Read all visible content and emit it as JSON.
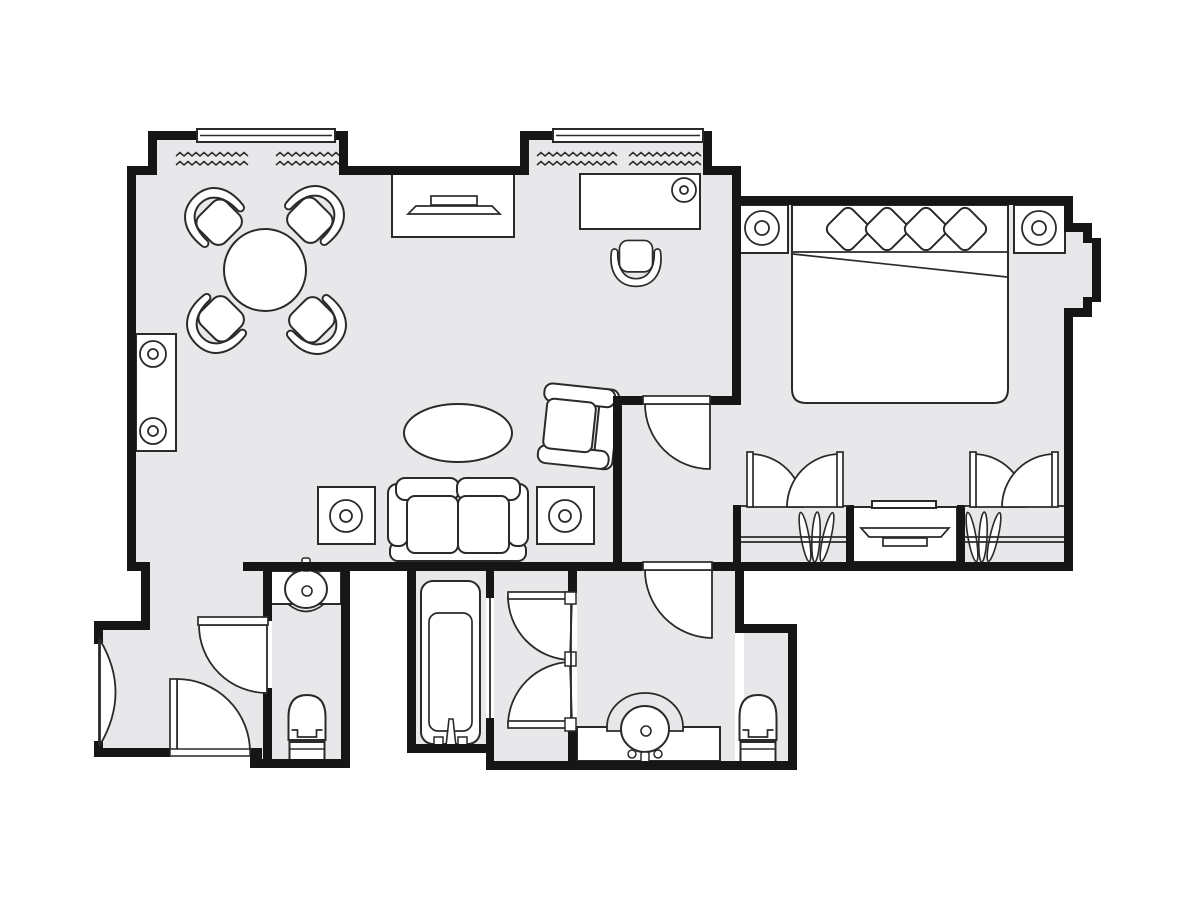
{
  "title": "hotel-suite-floor-plan",
  "canvas": {
    "w": 1200,
    "h": 900
  },
  "colors": {
    "bg": "#ffffff",
    "floor": "#e8e8ea",
    "wall": "#161616",
    "line": "#2a2a2a",
    "fill": "#ffffff"
  },
  "floors": [
    [
      136,
      172,
      601,
      395
    ],
    [
      157,
      140,
      182,
      35
    ],
    [
      529,
      140,
      174,
      35
    ],
    [
      741,
      205,
      323,
      357
    ],
    [
      622,
      405,
      119,
      157
    ],
    [
      1064,
      232,
      19,
      76
    ],
    [
      1083,
      243,
      9,
      54
    ],
    [
      150,
      562,
      115,
      68
    ],
    [
      103,
      630,
      162,
      127
    ],
    [
      272,
      571,
      69,
      190
    ],
    [
      416,
      571,
      70,
      173
    ],
    [
      494,
      571,
      74,
      190
    ],
    [
      577,
      571,
      158,
      190
    ],
    [
      744,
      633,
      44,
      128
    ]
  ],
  "curtains": [
    {
      "name": "curtain-squiggle-1",
      "x": 176,
      "y": 154,
      "len": 72
    },
    {
      "name": "curtain-squiggle-2",
      "x": 276,
      "y": 154,
      "len": 60
    },
    {
      "name": "curtain-squiggle-3",
      "x": 537,
      "y": 154,
      "len": 76
    },
    {
      "name": "curtain-squiggle-4",
      "x": 629,
      "y": 154,
      "len": 70
    }
  ],
  "windows": [
    {
      "name": "bay-window-left",
      "x": 197,
      "y": 129,
      "w": 138,
      "h": 13
    },
    {
      "name": "bay-window-right",
      "x": 553,
      "y": 129,
      "w": 150,
      "h": 13
    }
  ],
  "walls": [
    [
      127,
      166,
      23,
      9
    ],
    [
      345,
      166,
      177,
      9
    ],
    [
      703,
      166,
      38,
      9
    ],
    [
      732,
      166,
      9,
      239
    ],
    [
      127,
      166,
      9,
      405
    ],
    [
      732,
      196,
      341,
      9
    ],
    [
      1064,
      196,
      9,
      36
    ],
    [
      1064,
      223,
      28,
      9
    ],
    [
      1083,
      223,
      9,
      20
    ],
    [
      1092,
      238,
      9,
      64
    ],
    [
      1083,
      297,
      9,
      20
    ],
    [
      1064,
      308,
      28,
      9
    ],
    [
      1064,
      308,
      9,
      263
    ],
    [
      712,
      562,
      361,
      9
    ],
    [
      243,
      562,
      400,
      9
    ],
    [
      613,
      396,
      9,
      175
    ],
    [
      613,
      396,
      30,
      9
    ],
    [
      710,
      396,
      31,
      9
    ],
    [
      136,
      562,
      14,
      9
    ],
    [
      141,
      562,
      9,
      68
    ],
    [
      94,
      621,
      56,
      9
    ],
    [
      94,
      630,
      9,
      14
    ],
    [
      94,
      741,
      9,
      16
    ],
    [
      94,
      748,
      76,
      9
    ],
    [
      250,
      748,
      12,
      20
    ],
    [
      254,
      759,
      96,
      9
    ],
    [
      341,
      562,
      9,
      206
    ],
    [
      263,
      562,
      9,
      59
    ],
    [
      263,
      688,
      9,
      80
    ],
    [
      407,
      562,
      9,
      191
    ],
    [
      407,
      744,
      87,
      9
    ],
    [
      486,
      562,
      8,
      36
    ],
    [
      486,
      718,
      8,
      52
    ],
    [
      486,
      761,
      91,
      9
    ],
    [
      568,
      562,
      9,
      31
    ],
    [
      568,
      731,
      9,
      39
    ],
    [
      568,
      761,
      229,
      9
    ],
    [
      788,
      624,
      9,
      146
    ],
    [
      735,
      624,
      62,
      9
    ],
    [
      735,
      562,
      9,
      71
    ],
    [
      846,
      505,
      8,
      57
    ],
    [
      957,
      505,
      8,
      57
    ],
    [
      733,
      505,
      8,
      57
    ],
    [
      148,
      131,
      9,
      44
    ],
    [
      339,
      131,
      9,
      44
    ],
    [
      148,
      131,
      49,
      9
    ],
    [
      335,
      131,
      13,
      9
    ],
    [
      520,
      131,
      9,
      44
    ],
    [
      703,
      131,
      9,
      44
    ],
    [
      520,
      131,
      33,
      9
    ]
  ],
  "doors": {
    "wedges": [
      {
        "name": "entry-door",
        "d": "M 177,752 L 177,679 A 73,73 0 0 1 250,752 Z"
      },
      {
        "name": "powder-room-door",
        "d": "M 267,625 L 199,625 A 68,68 0 0 0 267,693 Z"
      },
      {
        "name": "hallway-door",
        "d": "M 710,404 L 645,404 A 65,65 0 0 0 710,469 Z"
      },
      {
        "name": "bathroom-door",
        "d": "M 712,570 L 645,570 A 68,68 0 0 0 712,638 Z"
      },
      {
        "name": "dressing-door-upper",
        "d": "M 572,596 L 508,596 A 64,64 0 0 0 570,660 Z"
      },
      {
        "name": "dressing-door-lower",
        "d": "M 572,724 L 508,724 A 64,64 0 0 1 570,662 Z"
      },
      {
        "name": "closet-left-door-left",
        "d": "M 750,507 L 750,454 A 53,53 0 0 1 803,507 Z"
      },
      {
        "name": "closet-left-door-right",
        "d": "M 840,507 L 840,454 A 53,53 0 0 0 787,507 Z"
      },
      {
        "name": "closet-right-door-left",
        "d": "M 973,507 L 973,454 A 53,53 0 0 1 1026,507 Z"
      },
      {
        "name": "closet-right-door-right",
        "d": "M 1055,507 L 1055,454 A 53,53 0 0 0 1002,507 Z"
      }
    ],
    "leaves": [
      {
        "name": "entry-door-leaf",
        "x": 170,
        "y": 679,
        "w": 7,
        "h": 73
      },
      {
        "name": "powder-room-door-leaf",
        "x": 198,
        "y": 617,
        "w": 70,
        "h": 8
      },
      {
        "name": "hallway-door-leaf",
        "x": 643,
        "y": 396,
        "w": 67,
        "h": 8
      },
      {
        "name": "bathroom-door-leaf",
        "x": 643,
        "y": 562,
        "w": 69,
        "h": 8
      },
      {
        "name": "dressing-door-leaf-upper",
        "x": 508,
        "y": 592,
        "w": 62,
        "h": 7
      },
      {
        "name": "dressing-door-leaf-lower",
        "x": 508,
        "y": 721,
        "w": 62,
        "h": 7
      },
      {
        "name": "closet-left-leaf-1",
        "x": 747,
        "y": 452,
        "w": 6,
        "h": 55
      },
      {
        "name": "closet-left-leaf-2",
        "x": 837,
        "y": 452,
        "w": 6,
        "h": 55
      },
      {
        "name": "closet-right-leaf-1",
        "x": 970,
        "y": 452,
        "w": 6,
        "h": 55
      },
      {
        "name": "closet-right-leaf-2",
        "x": 1052,
        "y": 452,
        "w": 6,
        "h": 55
      }
    ],
    "ticks": [
      {
        "name": "hinge-jamb",
        "x": 565,
        "y": 592,
        "w": 11,
        "h": 12
      },
      {
        "name": "hinge-jamb",
        "x": 565,
        "y": 652,
        "w": 11,
        "h": 14
      },
      {
        "name": "hinge-jamb",
        "x": 565,
        "y": 718,
        "w": 11,
        "h": 13
      }
    ],
    "lens": {
      "name": "connecting-door",
      "d": "M 100,640 Q 131,692 100,745 Z"
    },
    "threshold": {
      "name": "entry-threshold",
      "x": 170,
      "y": 749,
      "w": 80,
      "h": 7
    }
  },
  "lines": [
    {
      "name": "tub-opening-line",
      "x1": 490,
      "y1": 598,
      "x2": 490,
      "y2": 718
    },
    {
      "name": "dressing-wall-line",
      "x1": 571,
      "y1": 604,
      "x2": 571,
      "y2": 718
    },
    {
      "name": "connecting-door-jamb",
      "x1": 99,
      "y1": 640,
      "x2": 99,
      "y2": 745
    },
    {
      "name": "closet-front-stub",
      "x1": 741,
      "y1": 506,
      "x2": 748,
      "y2": 506
    },
    {
      "name": "closet-front-stub",
      "x1": 842,
      "y1": 506,
      "x2": 849,
      "y2": 506
    },
    {
      "name": "closet-front-stub",
      "x1": 964,
      "y1": 506,
      "x2": 971,
      "y2": 506
    },
    {
      "name": "closet-front-stub",
      "x1": 1057,
      "y1": 506,
      "x2": 1064,
      "y2": 506
    },
    {
      "name": "closet-shelf-line",
      "x1": 741,
      "y1": 537,
      "x2": 846,
      "y2": 537
    },
    {
      "name": "closet-shelf-line",
      "x1": 741,
      "y1": 542,
      "x2": 846,
      "y2": 542
    },
    {
      "name": "closet-shelf-line",
      "x1": 964,
      "y1": 537,
      "x2": 1064,
      "y2": 537
    },
    {
      "name": "closet-shelf-line",
      "x1": 964,
      "y1": 542,
      "x2": 1064,
      "y2": 542
    }
  ],
  "furniture": [
    {
      "type": "rect",
      "name": "console-table",
      "x": 136,
      "y": 334,
      "w": 40,
      "h": 117
    },
    {
      "type": "lamp",
      "name": "console-lamp-1",
      "cx": 153,
      "cy": 354,
      "r": 13,
      "r2": 5
    },
    {
      "type": "lamp",
      "name": "console-lamp-2",
      "cx": 153,
      "cy": 431,
      "r": 13,
      "r2": 5
    },
    {
      "type": "chair",
      "name": "dining-chair-nw",
      "cx": 216,
      "cy": 219,
      "rot": -45,
      "s": 1
    },
    {
      "type": "chair",
      "name": "dining-chair-ne",
      "cx": 313,
      "cy": 217,
      "rot": 45,
      "s": 1
    },
    {
      "type": "chair",
      "name": "dining-chair-sw",
      "cx": 218,
      "cy": 322,
      "rot": -135,
      "s": 1
    },
    {
      "type": "chair",
      "name": "dining-chair-se",
      "cx": 315,
      "cy": 323,
      "rot": 135,
      "s": 1
    },
    {
      "type": "circle",
      "name": "dining-table",
      "cx": 265,
      "cy": 270,
      "r": 41
    },
    {
      "type": "rect",
      "name": "tv-console",
      "x": 392,
      "y": 174,
      "w": 122,
      "h": 63
    },
    {
      "type": "tv",
      "name": "tv-living-room",
      "cx": 454,
      "cy": 205,
      "w": 92,
      "flip": false
    },
    {
      "type": "rect",
      "name": "desk",
      "x": 580,
      "y": 174,
      "w": 120,
      "h": 55
    },
    {
      "type": "lamp",
      "name": "desk-lamp",
      "cx": 684,
      "cy": 190,
      "r": 12,
      "r2": 4
    },
    {
      "type": "chair",
      "name": "desk-chair",
      "cx": 636,
      "cy": 260,
      "rot": 180,
      "s": 0.85
    },
    {
      "type": "ellipse",
      "name": "coffee-table",
      "cx": 458,
      "cy": 433,
      "rx": 54,
      "ry": 29
    },
    {
      "type": "armchair",
      "name": "armchair",
      "cx": 575,
      "cy": 426,
      "rot": 96
    },
    {
      "type": "sofa",
      "name": "sofa",
      "x": 388,
      "y": 478,
      "w": 140,
      "h": 83
    },
    {
      "type": "rect",
      "name": "end-table-left",
      "x": 318,
      "y": 487,
      "w": 57,
      "h": 57
    },
    {
      "type": "lamp",
      "name": "end-table-lamp-left",
      "cx": 346,
      "cy": 516,
      "r": 16,
      "r2": 6
    },
    {
      "type": "rect",
      "name": "end-table-right",
      "x": 537,
      "y": 487,
      "w": 57,
      "h": 57
    },
    {
      "type": "lamp",
      "name": "end-table-lamp-right",
      "cx": 565,
      "cy": 516,
      "r": 16,
      "r2": 6
    },
    {
      "type": "rect",
      "name": "nightstand-left",
      "x": 737,
      "y": 205,
      "w": 51,
      "h": 48
    },
    {
      "type": "lamp",
      "name": "nightstand-lamp-left",
      "cx": 762,
      "cy": 228,
      "r": 17,
      "r2": 7
    },
    {
      "type": "rect",
      "name": "nightstand-right",
      "x": 1014,
      "y": 205,
      "w": 51,
      "h": 48
    },
    {
      "type": "lamp",
      "name": "nightstand-lamp-right",
      "cx": 1039,
      "cy": 228,
      "r": 17,
      "r2": 7
    },
    {
      "type": "bed",
      "name": "bed",
      "x": 792,
      "y": 205,
      "w": 216,
      "h": 198,
      "pillows": [
        [
          848,
          229
        ],
        [
          887,
          229
        ],
        [
          926,
          229
        ],
        [
          965,
          229
        ]
      ],
      "pillow_s": 34,
      "sheet_y": 252,
      "fold_dy": 25
    },
    {
      "type": "rect",
      "name": "dresser",
      "x": 853,
      "y": 507,
      "w": 104,
      "h": 55
    },
    {
      "type": "rect",
      "name": "dresser-notch",
      "x": 872,
      "y": 501,
      "w": 64,
      "h": 7
    },
    {
      "type": "tv",
      "name": "tv-bedroom",
      "cx": 905,
      "cy": 538,
      "w": 88,
      "flip": true
    },
    {
      "type": "hangers",
      "name": "closet-hangers-left",
      "cx": 816,
      "cy": 537
    },
    {
      "type": "hangers",
      "name": "closet-hangers-right",
      "cx": 983,
      "cy": 537
    },
    {
      "type": "tub",
      "name": "bathtub",
      "x": 421,
      "y": 581,
      "w": 59,
      "h": 163
    },
    {
      "type": "rect",
      "name": "powder-vanity",
      "x": 267,
      "y": 571,
      "w": 74,
      "h": 33
    },
    {
      "type": "sink",
      "name": "powder-sink",
      "cx": 306,
      "cy": 589,
      "rx": 21,
      "ry": 19,
      "faucet": "up",
      "apron_y": 604
    },
    {
      "type": "toilet",
      "name": "powder-toilet",
      "cx": 307,
      "top": 695,
      "w": 37,
      "tank_h": 20
    },
    {
      "type": "rect",
      "name": "bath-vanity",
      "x": 577,
      "y": 727,
      "w": 143,
      "h": 34
    },
    {
      "type": "arch",
      "name": "bath-sink-arch",
      "cx": 645,
      "cy": 727,
      "r": 38
    },
    {
      "type": "sink",
      "name": "bath-sink",
      "cx": 645,
      "cy": 729,
      "rx": 24,
      "ry": 23,
      "faucet": "down"
    },
    {
      "type": "toilet",
      "name": "bath-toilet",
      "cx": 758,
      "top": 695,
      "w": 37,
      "tank_h": 20
    }
  ]
}
